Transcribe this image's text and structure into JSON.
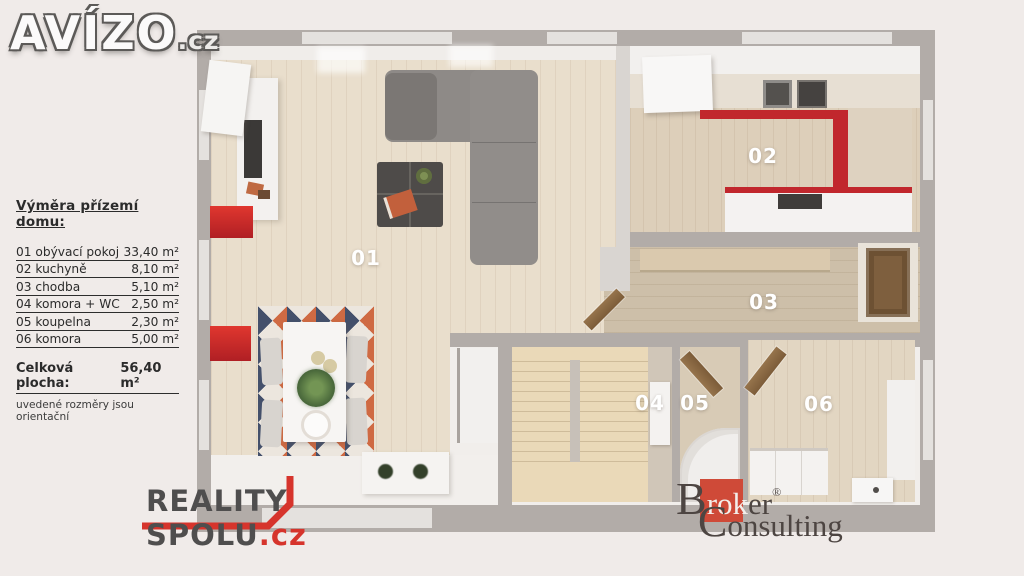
{
  "avizo_logo": {
    "name": "AVÍZO",
    "tld": ".cz"
  },
  "legend": {
    "title": "Výměra přízemí domu:",
    "rows": [
      {
        "label": "01 obývací pokoj",
        "area": "33,40 m²"
      },
      {
        "label": "02 kuchyně",
        "area": "8,10 m²"
      },
      {
        "label": "03 chodba",
        "area": "5,10 m²"
      },
      {
        "label": "04 komora + WC",
        "area": "2,50 m²"
      },
      {
        "label": "05 koupelna",
        "area": "2,30 m²"
      },
      {
        "label": "06 komora",
        "area": "5,00 m²"
      }
    ],
    "total_label": "Celková plocha:",
    "total_value": "56,40 m²",
    "note": "uvedené rozměry jsou orientační"
  },
  "plan": {
    "labels": {
      "r01": "01",
      "r02": "02",
      "r03": "03",
      "r04": "04",
      "r05": "05",
      "r06": "06"
    }
  },
  "reality_spolu_logo": {
    "line1": "REALITY",
    "line2": "SPOLU",
    "tld": ".cz"
  },
  "broker_logo": {
    "b": "B",
    "rok": "rok",
    "er": "er",
    "reg": "®",
    "c": "C",
    "rest": "onsulting"
  },
  "colors": {
    "background": "#f0ebe9",
    "wall_gray": "#b2aca8",
    "accent_red": "#c1272d",
    "reality_red": "#d6342c",
    "broker_red": "#cf4a38"
  }
}
